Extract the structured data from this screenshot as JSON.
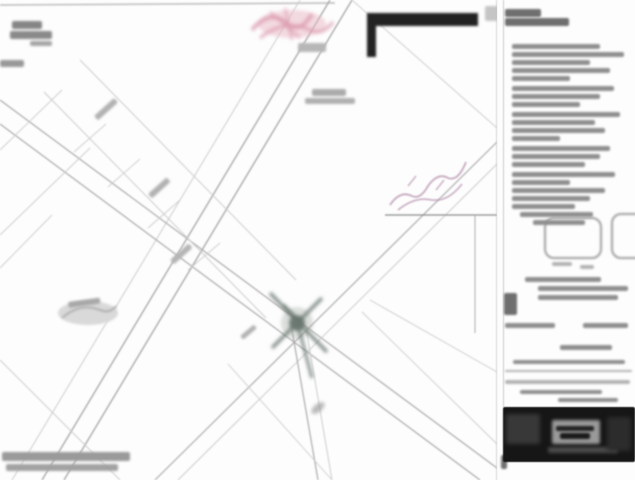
{
  "document": {
    "kind": "scanned subdivision plat / survey map, low resolution, text illegible"
  },
  "colors": {
    "paper": "#fdfdfd",
    "border": "#b8b8b8",
    "lineF": "#cccccc",
    "lineM": "#ababab",
    "lineD": "#8a8a8a",
    "junction": "#68766f",
    "junctionFill": "#5f6d66",
    "junctionHalo": "#9aa49e",
    "pink": "#eab6c4",
    "pinkDeep": "#dc9cb0",
    "inkPurple": "#bb9ab4",
    "pond": "#d9d9d9",
    "noteD": "#6f6f6f",
    "noteM": "#8f8f8f",
    "noteL": "#b3b3b3",
    "black": "#161616"
  },
  "map": {
    "lines": [
      [
        0,
        5,
        335,
        3,
        2,
        "f"
      ],
      [
        330,
        0,
        42,
        480,
        1.4,
        "m"
      ],
      [
        352,
        0,
        64,
        480,
        1.4,
        "m"
      ],
      [
        300,
        0,
        12,
        480,
        1,
        "f"
      ],
      [
        352,
        0,
        497,
        128,
        0.9,
        "f"
      ],
      [
        0,
        100,
        497,
        468,
        1.2,
        "m"
      ],
      [
        0,
        124,
        480,
        480,
        1.2,
        "m"
      ],
      [
        497,
        142,
        155,
        480,
        1.2,
        "m"
      ],
      [
        497,
        164,
        178,
        480,
        1,
        "f"
      ],
      [
        292,
        330,
        318,
        480,
        1.2,
        "m"
      ],
      [
        306,
        328,
        332,
        480,
        1,
        "f"
      ],
      [
        385,
        215,
        497,
        215,
        1.2,
        "d"
      ],
      [
        475,
        215,
        475,
        333,
        1,
        "m"
      ],
      [
        44,
        92,
        266,
        318,
        1,
        "f"
      ],
      [
        80,
        60,
        296,
        280,
        1,
        "f"
      ],
      [
        74,
        152,
        106,
        124,
        0.9,
        "f"
      ],
      [
        108,
        187,
        140,
        159,
        0.9,
        "f"
      ],
      [
        148,
        228,
        180,
        200,
        0.9,
        "f"
      ],
      [
        188,
        270,
        220,
        243,
        0.9,
        "f"
      ],
      [
        0,
        150,
        62,
        90,
        0.9,
        "f"
      ],
      [
        0,
        235,
        90,
        148,
        0.9,
        "f"
      ],
      [
        0,
        268,
        52,
        215,
        0.9,
        "f"
      ],
      [
        0,
        360,
        120,
        480,
        1,
        "f"
      ],
      [
        228,
        364,
        332,
        480,
        0.9,
        "f"
      ],
      [
        362,
        312,
        497,
        444,
        0.9,
        "f"
      ],
      [
        370,
        300,
        497,
        372,
        0.9,
        "f"
      ]
    ],
    "junction_lines": [
      [
        270,
        293,
        327,
        352,
        3.5
      ],
      [
        322,
        298,
        272,
        348,
        3.5
      ],
      [
        296,
        318,
        312,
        378,
        3
      ],
      [
        283,
        305,
        300,
        322,
        4
      ]
    ],
    "label_smudges": [
      [
        12,
        21,
        30,
        8,
        0,
        "#858585"
      ],
      [
        10,
        31,
        42,
        8,
        0,
        "#8a8a8a"
      ],
      [
        30,
        41,
        22,
        5,
        0,
        "#a5a5a5"
      ],
      [
        0,
        60,
        24,
        7,
        0,
        "#989898"
      ],
      [
        312,
        89,
        34,
        7,
        0,
        "#ababab"
      ],
      [
        305,
        98,
        50,
        6,
        0,
        "#b0b0b0"
      ],
      [
        94,
        116,
        27,
        6,
        -42,
        "#b2b2b2"
      ],
      [
        148,
        194,
        25,
        6,
        -42,
        "#b2b2b2"
      ],
      [
        170,
        260,
        25,
        6,
        -42,
        "#b5b5b5"
      ],
      [
        68,
        302,
        32,
        6,
        -8,
        "#a8a8a8"
      ],
      [
        2,
        452,
        128,
        9,
        0,
        "#9a9a9a"
      ],
      [
        6,
        464,
        112,
        7,
        0,
        "#a2a2a2"
      ],
      [
        485,
        6,
        13,
        15,
        0,
        "#c5c5c5"
      ],
      [
        298,
        43,
        28,
        9,
        0,
        "#b7b7b7"
      ],
      [
        240,
        336,
        18,
        5,
        -40,
        "#b3b3b3"
      ]
    ]
  },
  "sidebar": {
    "note_lines": [
      [
        505,
        9,
        36,
        8,
        "d"
      ],
      [
        505,
        18,
        64,
        8,
        "d"
      ],
      [
        512,
        44,
        88,
        5,
        "m"
      ],
      [
        512,
        52,
        112,
        5,
        "m"
      ],
      [
        512,
        60,
        78,
        5,
        "m"
      ],
      [
        512,
        68,
        98,
        5,
        "m"
      ],
      [
        512,
        76,
        58,
        5,
        "m"
      ],
      [
        512,
        86,
        102,
        5,
        "m"
      ],
      [
        512,
        94,
        88,
        5,
        "m"
      ],
      [
        512,
        102,
        68,
        5,
        "m"
      ],
      [
        512,
        112,
        108,
        5,
        "m"
      ],
      [
        512,
        120,
        83,
        5,
        "m"
      ],
      [
        512,
        128,
        93,
        5,
        "m"
      ],
      [
        512,
        136,
        48,
        5,
        "m"
      ],
      [
        512,
        146,
        98,
        5,
        "m"
      ],
      [
        512,
        154,
        88,
        5,
        "m"
      ],
      [
        512,
        162,
        73,
        5,
        "m"
      ],
      [
        512,
        172,
        103,
        5,
        "m"
      ],
      [
        512,
        180,
        58,
        5,
        "m"
      ],
      [
        512,
        188,
        93,
        5,
        "m"
      ],
      [
        512,
        196,
        78,
        5,
        "m"
      ],
      [
        512,
        204,
        63,
        5,
        "m"
      ],
      [
        520,
        212,
        73,
        5,
        "m"
      ],
      [
        533,
        220,
        52,
        5,
        "m"
      ],
      [
        552,
        262,
        20,
        4,
        "l"
      ],
      [
        580,
        265,
        14,
        4,
        "l"
      ],
      [
        525,
        277,
        76,
        5,
        "m"
      ],
      [
        538,
        286,
        90,
        5,
        "m"
      ],
      [
        538,
        295,
        80,
        5,
        "m"
      ],
      [
        504,
        293,
        13,
        22,
        "d"
      ],
      [
        505,
        323,
        50,
        5,
        "m"
      ],
      [
        583,
        323,
        45,
        5,
        "m"
      ],
      [
        560,
        345,
        52,
        5,
        "m"
      ],
      [
        513,
        360,
        112,
        4,
        "m"
      ],
      [
        505,
        370,
        127,
        2,
        "l"
      ],
      [
        505,
        380,
        125,
        4,
        "l"
      ],
      [
        520,
        390,
        82,
        4,
        "m"
      ],
      [
        558,
        398,
        60,
        4,
        "m"
      ],
      [
        501,
        455,
        6,
        14,
        "d"
      ]
    ],
    "title_block": {
      "x": 503,
      "y": 407,
      "w": 132,
      "h": 55
    }
  }
}
